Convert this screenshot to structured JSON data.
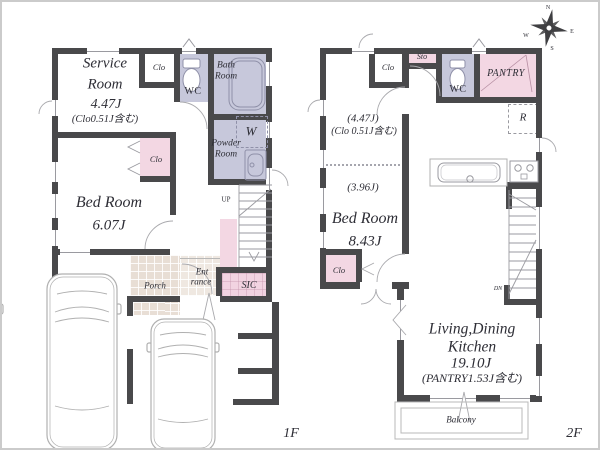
{
  "compass": {
    "n": "N",
    "e": "E",
    "s": "S",
    "w": "W"
  },
  "floor1": {
    "label": "1F",
    "service_room": {
      "name_line1": "Service",
      "name_line2": "Room",
      "area": "4.47J",
      "note": "(Clo0.51J含む)"
    },
    "clo_top": "Clo",
    "wc": "WC",
    "bath_line1": "Bath",
    "bath_line2": "Room",
    "powder_line1": "Powder",
    "powder_line2": "Room",
    "washer": "W",
    "bed_room": {
      "name": "Bed Room",
      "area": "6.07J"
    },
    "clo_mid": "Clo",
    "up": "UP",
    "porch": "Porch",
    "entrance_line1": "Ent",
    "entrance_line2": "rance",
    "sic": "SIC"
  },
  "floor2": {
    "label": "2F",
    "clo_top": "Clo",
    "sto": "Sto",
    "wc": "WC",
    "pantry": "PANTRY",
    "fridge": "R",
    "bedroom_part1_area": "(4.47J)",
    "bedroom_part1_note": "(Clo 0.51J含む)",
    "bedroom_part2_area": "(3.96J)",
    "bed_room": {
      "name": "Bed Room",
      "area": "8.43J"
    },
    "clo_bottom": "Clo",
    "dn": "DN",
    "ldk": {
      "name_line1": "Living,Dining",
      "name_line2": "Kitchen",
      "area": "19.10J",
      "note": "(PANTRY1.53J含む)"
    },
    "balcony": "Balcony"
  },
  "colors": {
    "wall": "#49494b",
    "wet_room": "#c7c8db",
    "closet_pink": "#f3d7e3",
    "tile": "#e8ded5"
  }
}
